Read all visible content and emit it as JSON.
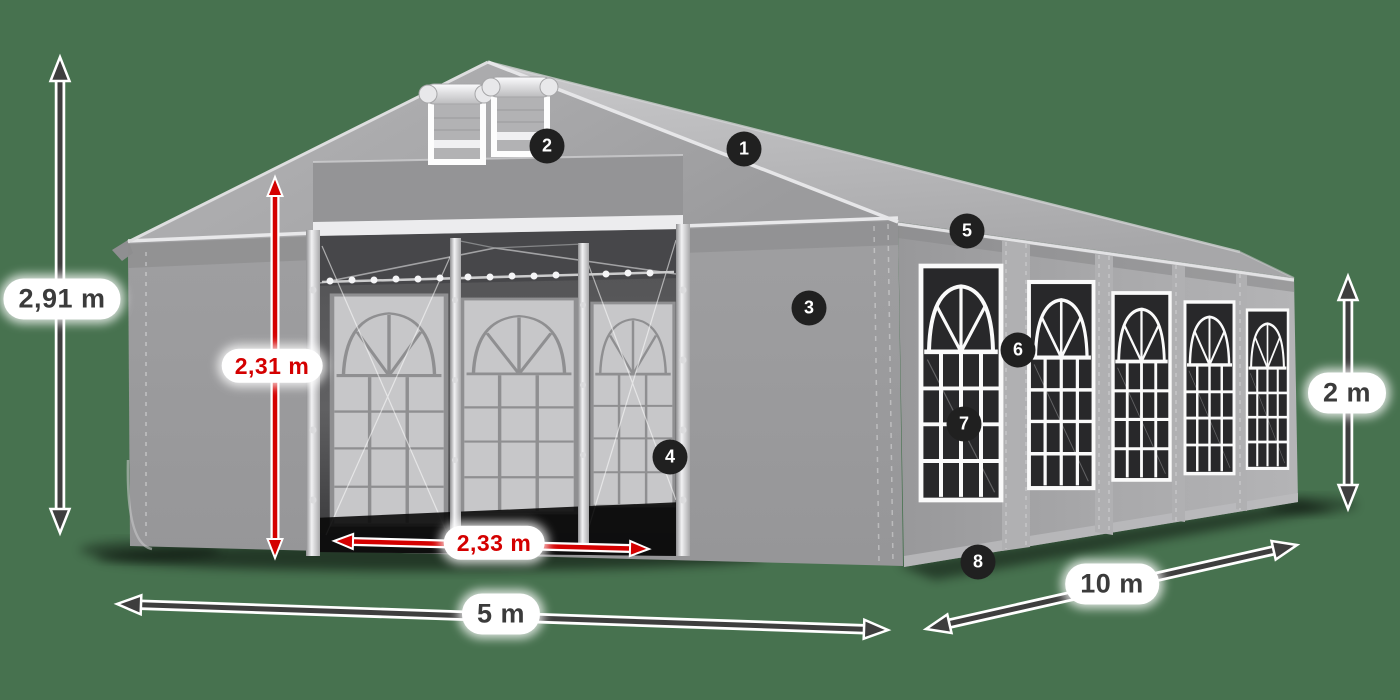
{
  "page": {
    "background_color": "#47724f",
    "description": "3D product diagram of a gray marquee party tent (5 x 10 m) with dimension arrows and 8 numbered feature callouts"
  },
  "diagram": {
    "product": "party tent / marquee, gray tarpaulin with arched windows",
    "dimensions": [
      {
        "id": "total-height",
        "label": "2,91 m",
        "value": 2.91,
        "unit": "m",
        "style": "dark",
        "orientation": "vertical",
        "measures": "overall ridge height"
      },
      {
        "id": "entrance-height",
        "label": "2,31 m",
        "value": 2.31,
        "unit": "m",
        "style": "red",
        "orientation": "vertical",
        "measures": "entrance clear height"
      },
      {
        "id": "entrance-width",
        "label": "2,33 m",
        "value": 2.33,
        "unit": "m",
        "style": "red",
        "orientation": "horizontal",
        "measures": "entrance clear width"
      },
      {
        "id": "front-width",
        "label": "5 m",
        "value": 5,
        "unit": "m",
        "style": "dark",
        "orientation": "horizontal",
        "measures": "tent width"
      },
      {
        "id": "side-length",
        "label": "10 m",
        "value": 10,
        "unit": "m",
        "style": "dark",
        "orientation": "diagonal",
        "measures": "tent length"
      },
      {
        "id": "side-wall-height",
        "label": "2 m",
        "value": 2,
        "unit": "m",
        "style": "dark",
        "orientation": "vertical",
        "measures": "side wall height"
      }
    ],
    "callouts": [
      {
        "number": "1",
        "placement": "roof"
      },
      {
        "number": "2",
        "placement": "gable-vents"
      },
      {
        "number": "3",
        "placement": "front-wall"
      },
      {
        "number": "4",
        "placement": "entrance-frame"
      },
      {
        "number": "5",
        "placement": "eave"
      },
      {
        "number": "6",
        "placement": "side-window-top"
      },
      {
        "number": "7",
        "placement": "side-window"
      },
      {
        "number": "8",
        "placement": "wall-skirt"
      }
    ],
    "colors": {
      "background": "#47724f",
      "arrow_dark": "#3e3e3e",
      "arrow_red": "#d40000",
      "badge_background": "#202020",
      "badge_text": "#ffffff",
      "label_background": "#ffffff",
      "label_text_dark": "#3b3b3b",
      "label_text_red": "#d40000",
      "tent_gray": "#a6a6a8",
      "window_dark": "#28282a",
      "frame_white": "#fafafa"
    }
  }
}
